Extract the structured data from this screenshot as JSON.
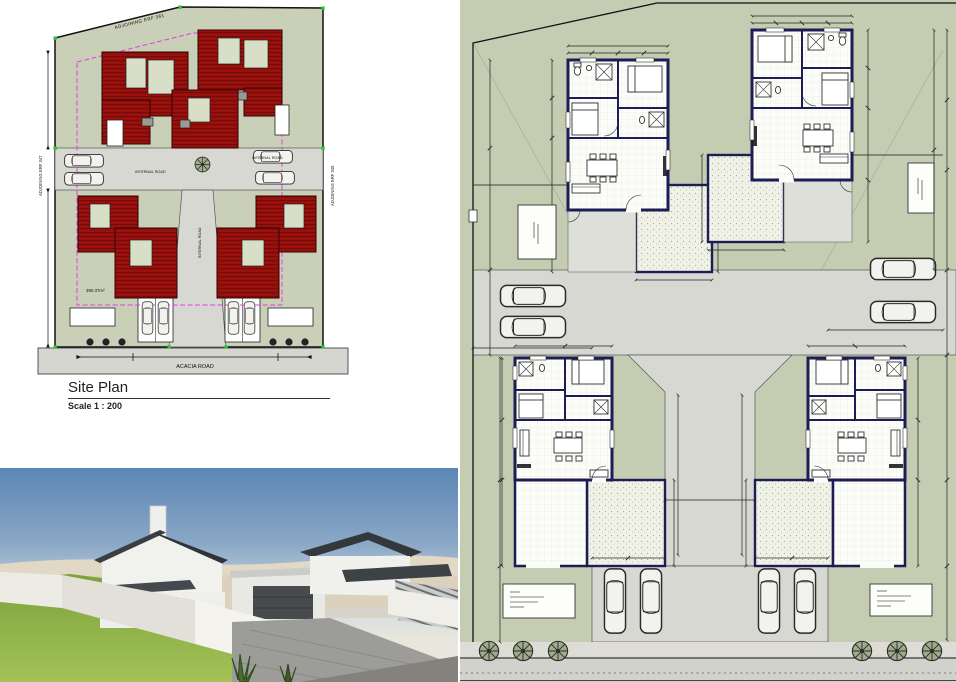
{
  "sheet": {
    "background": "#ffffff"
  },
  "site_plan": {
    "title": "Site Plan",
    "scale_label": "Scale 1 : 200",
    "labels": {
      "adjoining_top": "ADJOINING ERF 361",
      "adjoining_left": "ADJOINING ERF 347",
      "adjoining_right": "ADJOINING ERF 345",
      "internal_road": "INTERNAL ROAD",
      "acacia_road": "ACACIA ROAD",
      "stand_area": "390.37m²"
    },
    "colors": {
      "site_green": "#cad0b8",
      "roof_red": "#9b100d",
      "roof_ridge": "#730b08",
      "road_gray": "#d8d8d3",
      "building_line_magenta": "#e23ee2",
      "corner_marker_green": "#2bc42b"
    }
  },
  "floor_plan": {
    "colors": {
      "ground_green": "#c4cdb2",
      "wall_navy": "#1d1d55",
      "road_gray": "#d8d8d3",
      "courtyard_stipple": "#f0f1e7"
    }
  },
  "render_3d": {
    "colors": {
      "sky_top": "#5b86b5",
      "sky_horizon": "#e9e6dd",
      "sand": "#e2d8c6",
      "lawn_green": "#8fb24a",
      "roof_dark": "#3a3f44",
      "wall_white": "#f1f1ee",
      "paving_gray": "#9c9c98"
    }
  }
}
